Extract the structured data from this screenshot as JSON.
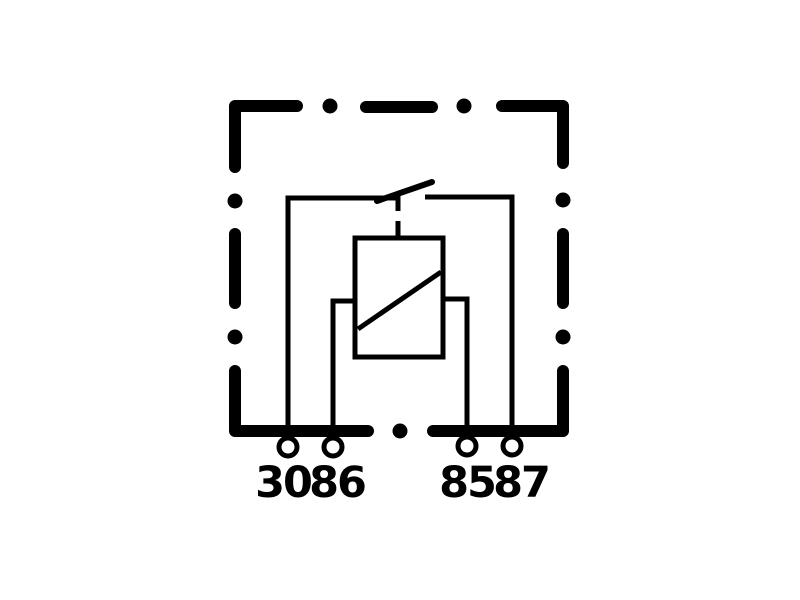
{
  "diagram": {
    "title": "relay-wiring-schematic",
    "background_color": "#ffffff",
    "line_color": "#000000",
    "housing": {
      "style": "dash-dot-outline"
    },
    "components": [
      {
        "name": "switch-contact",
        "description": "normally-open contact between terminal 30 and terminal 87"
      },
      {
        "name": "coil",
        "description": "relay coil between terminal 86 and terminal 85"
      }
    ],
    "terminals": [
      {
        "id": "terminal-30",
        "label": "30"
      },
      {
        "id": "terminal-86",
        "label": "86"
      },
      {
        "id": "terminal-85",
        "label": "85"
      },
      {
        "id": "terminal-87",
        "label": "87"
      }
    ]
  }
}
